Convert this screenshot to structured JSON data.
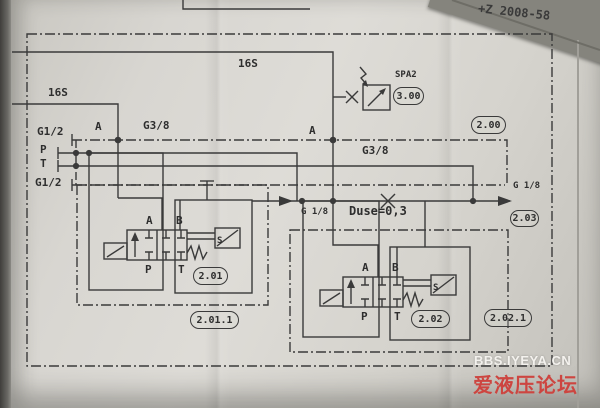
{
  "page": {
    "doc_number": "+Z 2008-58",
    "watermark_line1": "BBS.IYEYA.CN",
    "watermark_line2": "爱液压论坛"
  },
  "labels": {
    "box_16s_outer": "16S",
    "box_16s_inner": "16S",
    "port_g12_top": "G1/2",
    "port_p": "P",
    "port_t": "T",
    "port_g12_bottom": "G1/2",
    "junction_a_left": "A",
    "junction_a_right": "A",
    "line_g38_left": "G3/8",
    "line_g38_right": "G3/8",
    "pressure_switch_tag": "SPA2",
    "port_g18_mid": "G 1/8",
    "orifice": "Duse=0,3",
    "port_g18_right": "G 1/8"
  },
  "refs": {
    "pressure_switch": "3.00",
    "circuit_top": "2.00",
    "port_right": "2.03",
    "valve_left": "2.01",
    "assembly_left": "2.01.1",
    "valve_right": "2.02",
    "assembly_right": "2.02.1"
  },
  "valve_left": {
    "a": "A",
    "b": "B",
    "p": "P",
    "t": "T",
    "solenoid": "S"
  },
  "valve_right": {
    "a": "A",
    "b": "B",
    "p": "P",
    "t": "T",
    "solenoid": "S"
  }
}
